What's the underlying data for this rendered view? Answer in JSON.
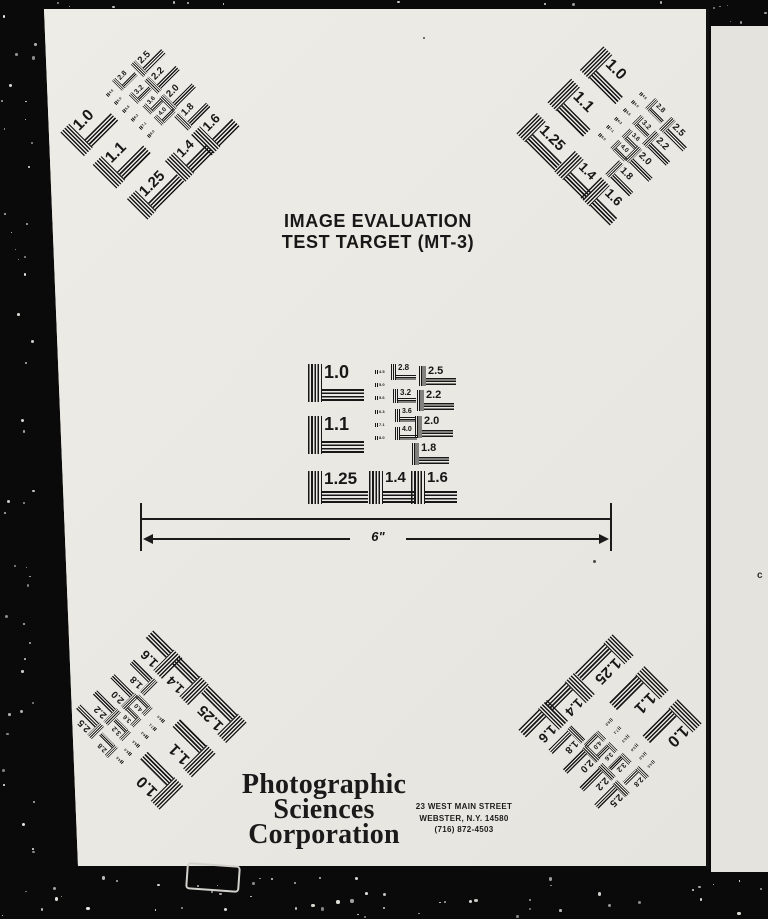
{
  "document": {
    "title_line1": "IMAGE EVALUATION",
    "title_line2": "TEST TARGET (MT-3)",
    "scale_label": "6\"",
    "logo_lines": [
      "Photographic",
      "Sciences",
      "Corporation"
    ],
    "address_lines": [
      "23 WEST MAIN STREET",
      "WEBSTER, N.Y. 14580",
      "(716) 872-4503"
    ],
    "margin_note": "c"
  },
  "test_pattern": {
    "large_values": [
      "1.0",
      "1.1",
      "1.25",
      "1.4",
      "1.6"
    ],
    "right_column_values": [
      "2.5",
      "2.2",
      "2.0",
      "1.8"
    ],
    "middle_column_values": [
      "2.8",
      "3.2",
      "3.6",
      "4.0"
    ],
    "micro_values": [
      "4.5",
      "5.0",
      "5.6",
      "6.3",
      "7.1",
      "8.0"
    ],
    "clusters": [
      {
        "id": "center",
        "cx": 382,
        "cy": 434,
        "rotation": 0,
        "scale": 1.0
      },
      {
        "id": "top-left",
        "cx": 150,
        "cy": 130,
        "rotation": -45,
        "scale": 0.88
      },
      {
        "id": "top-right",
        "cx": 606,
        "cy": 136,
        "rotation": 45,
        "scale": 0.88
      },
      {
        "id": "bottom-left",
        "cx": 157,
        "cy": 720,
        "rotation": -135,
        "scale": 0.88
      },
      {
        "id": "bottom-right",
        "cx": 610,
        "cy": 726,
        "rotation": 135,
        "scale": 0.9
      }
    ]
  },
  "colors": {
    "ink": "#171717",
    "paper": "#eae8e2",
    "paper_second_page": "#e5e3dd",
    "film_background": "#0a0a0a"
  }
}
